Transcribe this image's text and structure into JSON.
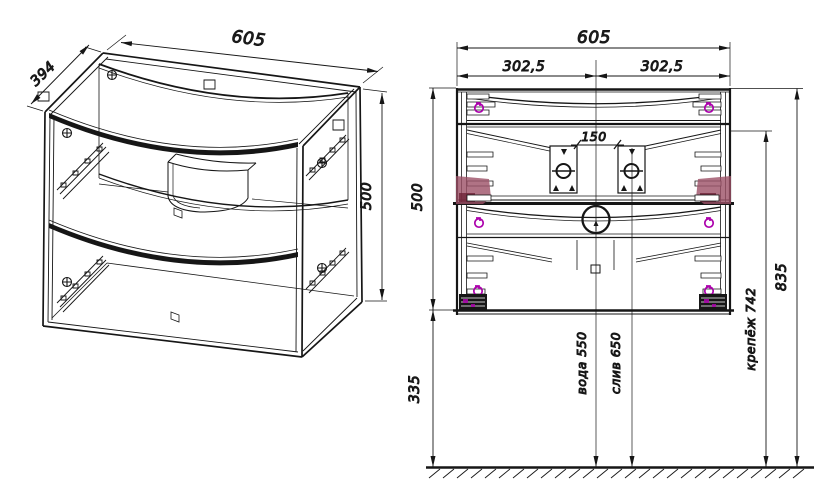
{
  "drawing": {
    "type": "furniture technical drawing, bathroom vanity cabinet, two views",
    "colors": {
      "line": "#161616",
      "text": "#222222",
      "fastener_magenta": "#ac00ac",
      "highlight_maroon": "#9c5066",
      "background": "#ffffff"
    },
    "iso_view": {
      "name": "isometric wireframe view",
      "width": "605",
      "depth": "394",
      "height": "500"
    },
    "front_view": {
      "name": "rear elevation with installation dimensions",
      "width": "605",
      "half_left": "302,5",
      "half_right": "302,5",
      "bracket_span": "150",
      "body_height": "500",
      "floor_gap": "335",
      "water_height": "вода 550",
      "drain_height": "слив 650",
      "mount_height": "крепёж 742",
      "total_height": "835"
    }
  }
}
